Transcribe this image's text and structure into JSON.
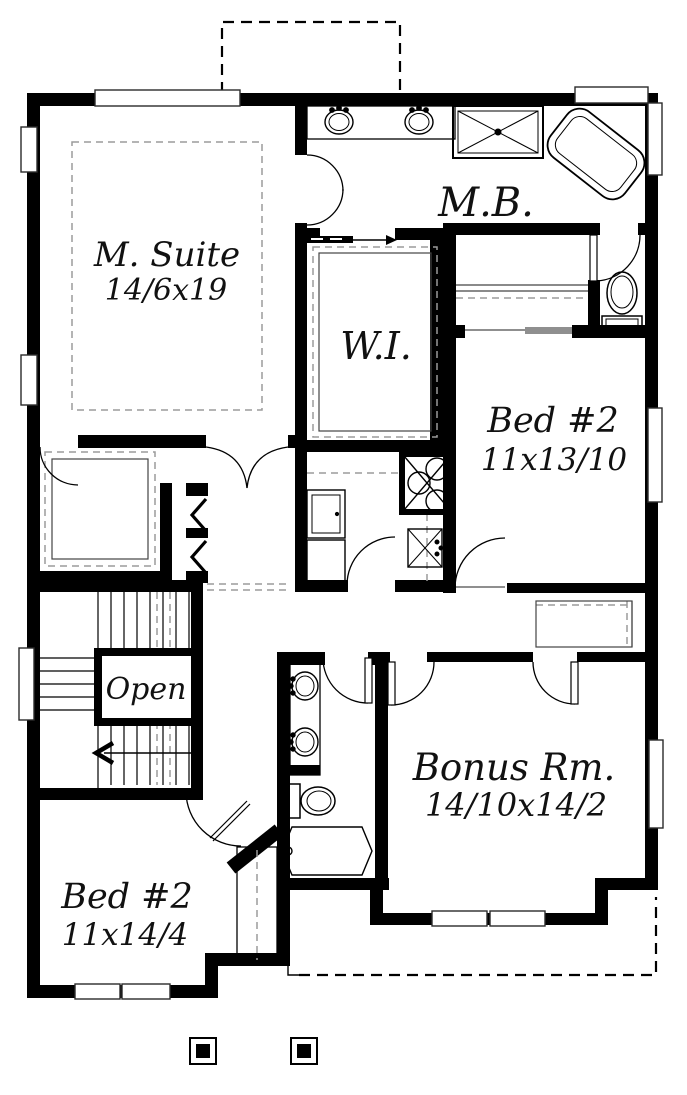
{
  "plan": {
    "type": "floor-plan",
    "rooms": [
      {
        "name": "master-suite",
        "label": "M. Suite",
        "dims": "14/6x19"
      },
      {
        "name": "master-bath",
        "label": "M.B.",
        "dims": ""
      },
      {
        "name": "walk-in-closet",
        "label": "W.I.",
        "dims": ""
      },
      {
        "name": "bed2-upper",
        "label": "Bed #2",
        "dims": "11x13/10"
      },
      {
        "name": "stair-open",
        "label": "Open",
        "dims": ""
      },
      {
        "name": "bonus-room",
        "label": "Bonus Rm.",
        "dims": "14/10x14/2"
      },
      {
        "name": "bed2-lower",
        "label": "Bed #2",
        "dims": "11x14/4"
      }
    ],
    "fixtures": [
      "double-vanity-sinks",
      "shower",
      "corner-tub",
      "toilet",
      "walk-in-shelves",
      "washer-dryer-stack",
      "laundry-cabinet",
      "laundry-sink",
      "hall-vanity-sinks",
      "hall-toilet",
      "bathtub",
      "stairs",
      "down-arrow",
      "pocket-door-arrow",
      "bifold-closet-doors",
      "porch-posts"
    ],
    "colors": {
      "walls": "#000000",
      "background": "#ffffff",
      "dashed_gray": "#9b9b9b",
      "header_gray": "#8f8f8f"
    }
  }
}
